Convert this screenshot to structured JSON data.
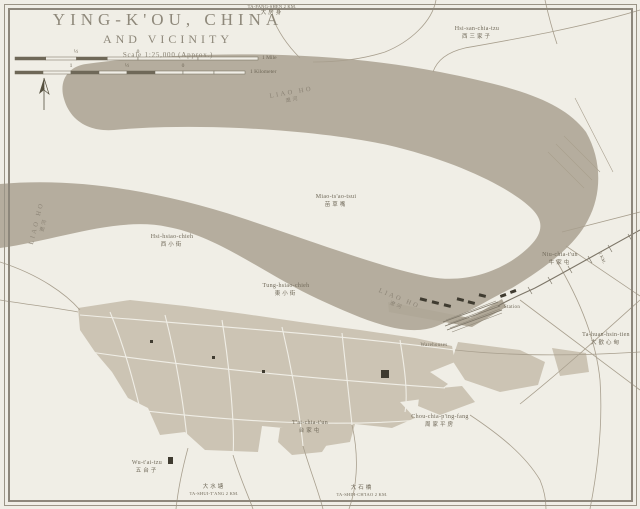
{
  "title": {
    "line1": "YING-K'OU, CHINA",
    "line2": "AND VICINITY",
    "scale_note": "Scale 1:25,000 (Approx.)"
  },
  "scale": {
    "mile_half": "½",
    "mile_zero": "0",
    "mile_unit": "1 Mile",
    "km_one": "1",
    "km_half": "½",
    "km_zero": "0",
    "km_unit": "1 Kilometer"
  },
  "river": {
    "name": "LIAO HO",
    "cn": "遼河"
  },
  "places": {
    "ta_fang_shen": {
      "name": "TA-FANG-SHEN 2 KM.",
      "cn": "大房身"
    },
    "hsi_san_chia_tzu": {
      "name": "Hsi-san-chia-tzu",
      "cn": "西三家子"
    },
    "miao_tsao_tsui": {
      "name": "Miao-ts'ao-tsui",
      "cn": "苗草嘴"
    },
    "hsi_hsiao_chieh": {
      "name": "Hsi-hsiao-chieh",
      "cn": "西小街"
    },
    "tung_hsiao_chieh": {
      "name": "Tung-hsiao-chieh",
      "cn": "東小街"
    },
    "niu_chia_tun": {
      "name": "Niu-chia-t'un",
      "cn": "牛家屯"
    },
    "ta_huan_hsin_tien": {
      "name": "Ta-huan-hsin-tien",
      "cn": "大歡心甸"
    },
    "chou_chia_ping_fang": {
      "name": "Chou-chia-p'ing-fang",
      "cn": "周家平房"
    },
    "tai_chia_tun": {
      "name": "T'ai-chia-t'un",
      "cn": "台家屯"
    },
    "wu_tai_tzu": {
      "name": "Wu-t'ai-tzu",
      "cn": "五台子"
    },
    "ta_shui_tang": {
      "name": "TA-SHUI-T'ANG 2 KM.",
      "cn": "大水塘"
    },
    "ta_shih_chiao": {
      "name": "TA-SHIH-CH'IAO 2 KM.",
      "cn": "大石橋"
    },
    "east_edge_road": {
      "name": "2 KM."
    }
  },
  "poi": {
    "station": "Station",
    "warehouses": "Warehouses"
  },
  "colors": {
    "paper": "#f0eee6",
    "river": "#b5ad9e",
    "urban": "#ccc4b4",
    "wharf": "#b0a898",
    "road": "#a89f8e",
    "ink": "#6f6858",
    "title_ink": "#8e887a",
    "building": "#3f3b30",
    "border": "#8d877b"
  }
}
